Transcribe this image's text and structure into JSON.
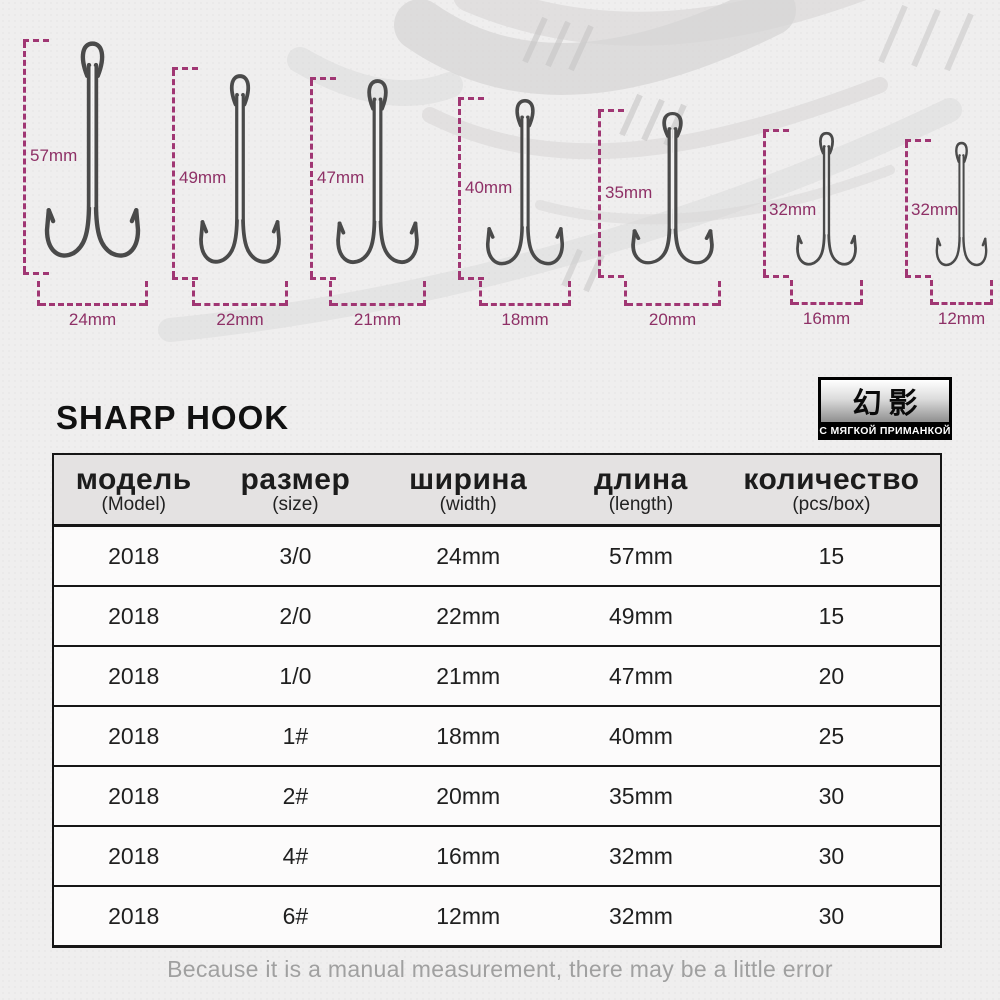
{
  "page": {
    "title": "SHARP HOOK",
    "footer_note": "Because it is a manual measurement, there may be a little error"
  },
  "brand_badge": {
    "logo_text": "幻影",
    "subtitle": "С МЯГКОЙ ПРИМАНКОЙ"
  },
  "colors": {
    "measure_dash": "#a03673",
    "measure_text": "#8e3066",
    "table_header_bg": "#e4e2e2",
    "badge_bg": "#000000",
    "page_bg": "#efeeee"
  },
  "hooks": [
    {
      "length": "57mm",
      "width": "24mm"
    },
    {
      "length": "49mm",
      "width": "22mm"
    },
    {
      "length": "47mm",
      "width": "21mm"
    },
    {
      "length": "40mm",
      "width": "18mm"
    },
    {
      "length": "35mm",
      "width": "20mm"
    },
    {
      "length": "32mm",
      "width": "16mm"
    },
    {
      "length": "32mm",
      "width": "12mm"
    }
  ],
  "table": {
    "headers": [
      {
        "label": "модель",
        "sub": "(Model)"
      },
      {
        "label": "размер",
        "sub": "(size)"
      },
      {
        "label": "ширина",
        "sub": "(width)"
      },
      {
        "label": "длина",
        "sub": "(length)"
      },
      {
        "label": "количество",
        "sub": "(pcs/box)"
      }
    ],
    "rows": [
      [
        "2018",
        "3/0",
        "24mm",
        "57mm",
        "15"
      ],
      [
        "2018",
        "2/0",
        "22mm",
        "49mm",
        "15"
      ],
      [
        "2018",
        "1/0",
        "21mm",
        "47mm",
        "20"
      ],
      [
        "2018",
        "1#",
        "18mm",
        "40mm",
        "25"
      ],
      [
        "2018",
        "2#",
        "20mm",
        "35mm",
        "30"
      ],
      [
        "2018",
        "4#",
        "16mm",
        "32mm",
        "30"
      ],
      [
        "2018",
        "6#",
        "12mm",
        "32mm",
        "30"
      ]
    ]
  }
}
